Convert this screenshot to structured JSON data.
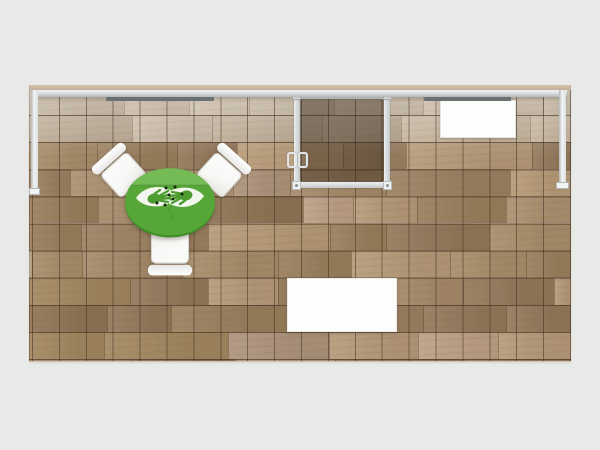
{
  "scene": {
    "description_label": "exhibit-booth-plan-view-render",
    "visible_text": [],
    "icons": {
      "table_logo": "two-hands-leaves-logo",
      "door_hardware": "door-pull-handles"
    }
  },
  "colors": {
    "canvas_bg": "#e9e9e8",
    "wall_top": "#c4b199",
    "rail": "#dcdfe0",
    "rail_dark": "#b4b8ba",
    "rail_light": "#f2f4f4",
    "light_bar": "#6b7072",
    "grid_line": "rgba(58,44,30,0.50)",
    "glass_frame": "#d9dcdd",
    "glass_tint": "rgba(48,34,20,0.42)",
    "white_surface": "#fdfdfc",
    "chair_white": "#f8f8f6",
    "chair_edge": "#d6d6d3",
    "table_green": "#57a738",
    "table_green_light": "#74ba55",
    "table_rim": "#3e8d26",
    "leaf_white": "#f3f6ee",
    "hand_green": "#4d9c30",
    "dot": "#17260f"
  },
  "floor": {
    "plank_seed": 20240617,
    "row_height": 27.1,
    "seam_color": "rgba(92,70,48,0.30)",
    "light_palette": [
      "#c6b5a0",
      "#bcab94",
      "#c0ae96",
      "#b2a189",
      "#cbbaa4",
      "#b8a78f"
    ],
    "wood_palette": [
      "#ab9070",
      "#a2875f",
      "#b59a79",
      "#997e5c",
      "#8f7454",
      "#a88d6a",
      "#bda085",
      "#93785a",
      "#ad937b",
      "#9c8162",
      "#b69a77",
      "#a58a69"
    ]
  }
}
